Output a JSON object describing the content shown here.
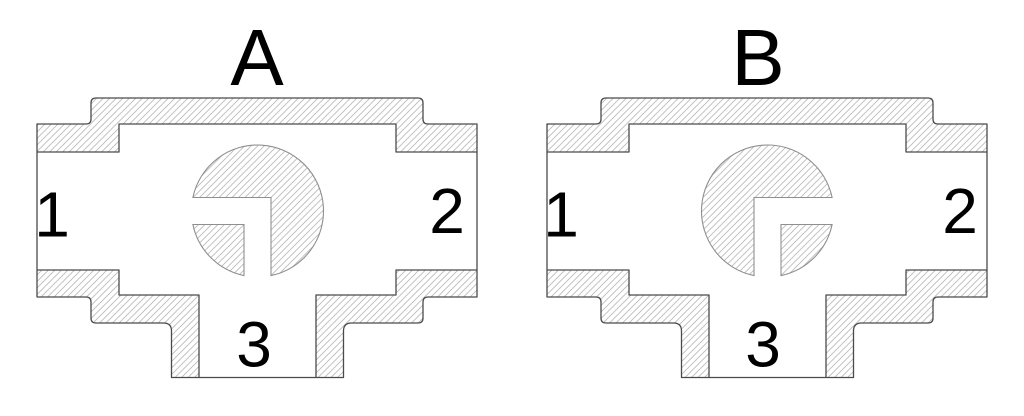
{
  "figure": {
    "type": "technical-cross-section",
    "subject": "Two cross-section views of a three-way (tee) L-port ball valve, positions A and B",
    "colors": {
      "background": "#ffffff",
      "outline": "#4a4a4a",
      "ball_outline": "#8f8f8f",
      "hatch": "#b9b9b9",
      "label": "#000000"
    },
    "diagrams": [
      {
        "title": "A",
        "ports": {
          "left": "1",
          "right": "2",
          "bottom": "3"
        },
        "valve_channel": "L-port channel open from left port 1 to bottom port 3"
      },
      {
        "title": "B",
        "ports": {
          "left": "1",
          "right": "2",
          "bottom": "3"
        },
        "valve_channel": "L-port channel open from right port 2 to bottom port 3"
      }
    ]
  }
}
